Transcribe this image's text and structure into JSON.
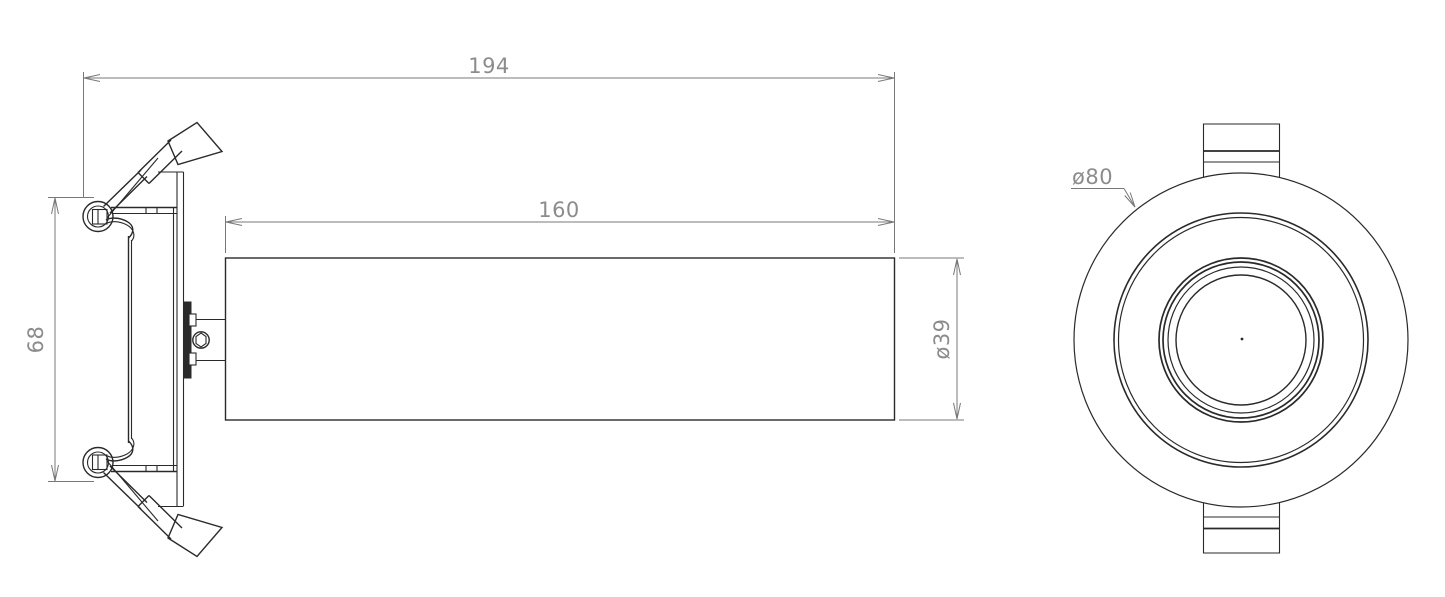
{
  "drawing": {
    "background_color": "#ffffff",
    "object_line_color": "#2a2a2a",
    "dimension_line_color": "#787878",
    "dimension_text_color": "#8c8c8c",
    "views": {
      "side_view": {
        "name": "spotlight side elevation"
      },
      "front_view": {
        "name": "spotlight front face"
      }
    },
    "dimensions": {
      "overall_length": {
        "label": "194"
      },
      "body_length": {
        "label": "160"
      },
      "recess_height": {
        "label": "68"
      },
      "tube_diameter": {
        "label": "ø39"
      },
      "face_diameter": {
        "label": "ø80"
      }
    }
  }
}
